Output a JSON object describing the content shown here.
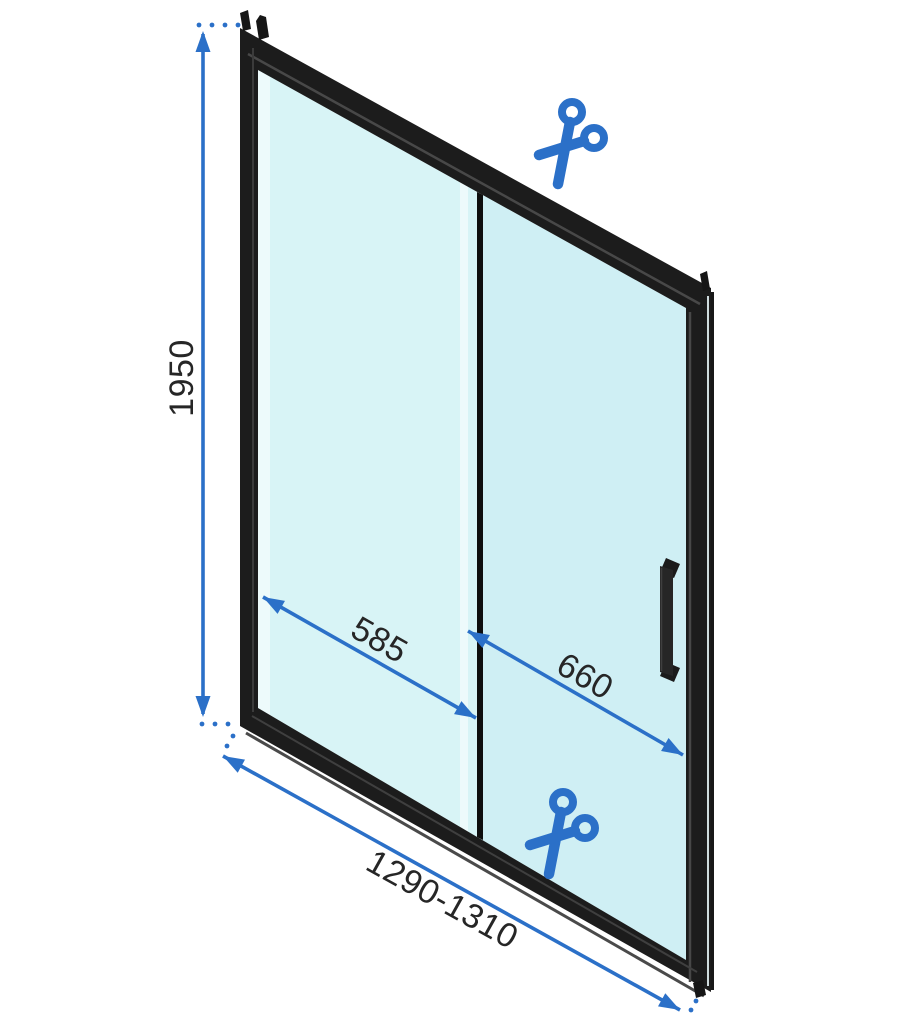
{
  "diagram": {
    "type": "sliding-shower-door-dimension-drawing",
    "dimension_labels": {
      "total_height": "1950",
      "fixed_panel_width": "585",
      "door_panel_width": "660",
      "total_width_range": "1290-1310"
    },
    "icons": {
      "top": "scissors-icon",
      "bottom": "scissors-icon"
    },
    "colors": {
      "dimension_blue": "#2b70c8",
      "label_text": "#262626",
      "frame_black": "#1c1c1c",
      "glass_fixed": "#d8f4f6",
      "glass_door": "#cfeff4",
      "glass_highlight": "#effbfc",
      "background": "#ffffff"
    }
  }
}
